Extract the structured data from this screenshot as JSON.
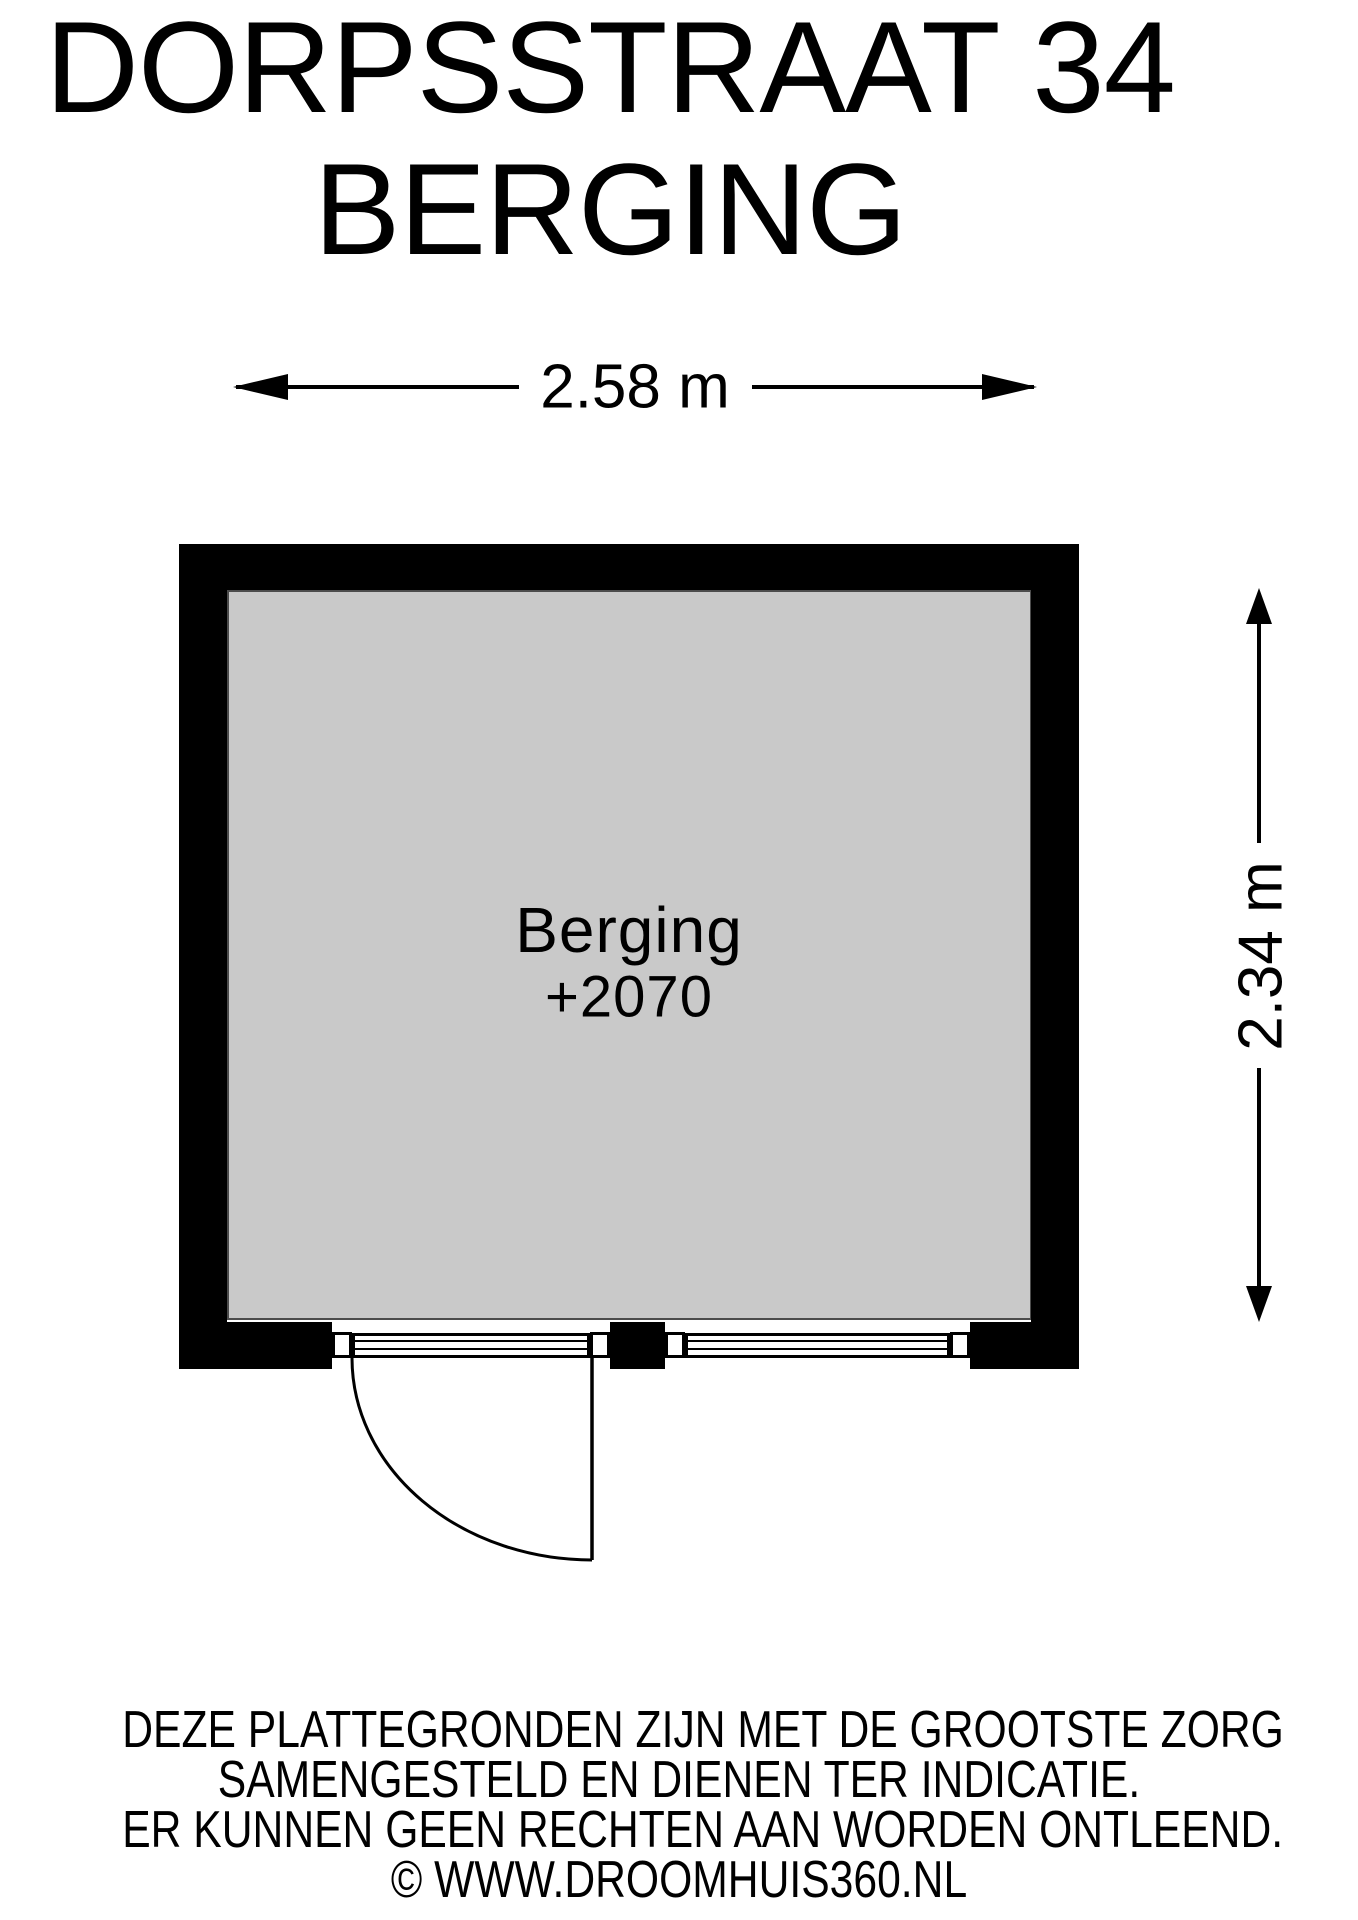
{
  "title": {
    "line1": "DORPSSTRAAT 34",
    "line2": "BERGING"
  },
  "dimensions": {
    "width_label": "2.58 m",
    "height_label": "2.34 m"
  },
  "room": {
    "name": "Berging",
    "elevation": "+2070"
  },
  "footer": {
    "line1": "DEZE PLATTEGRONDEN ZIJN MET DE GROOTSTE ZORG",
    "line2": "SAMENGESTELD EN DIENEN TER INDICATIE.",
    "line3": "ER KUNNEN GEEN RECHTEN AAN WORDEN ONTLEEND.",
    "line4": "© WWW.DROOMHUIS360.NL"
  },
  "colors": {
    "wall": "#000000",
    "floor": "#c9c9c9",
    "background": "#ffffff",
    "line": "#000000",
    "floor_edge": "#4c4c4c"
  }
}
